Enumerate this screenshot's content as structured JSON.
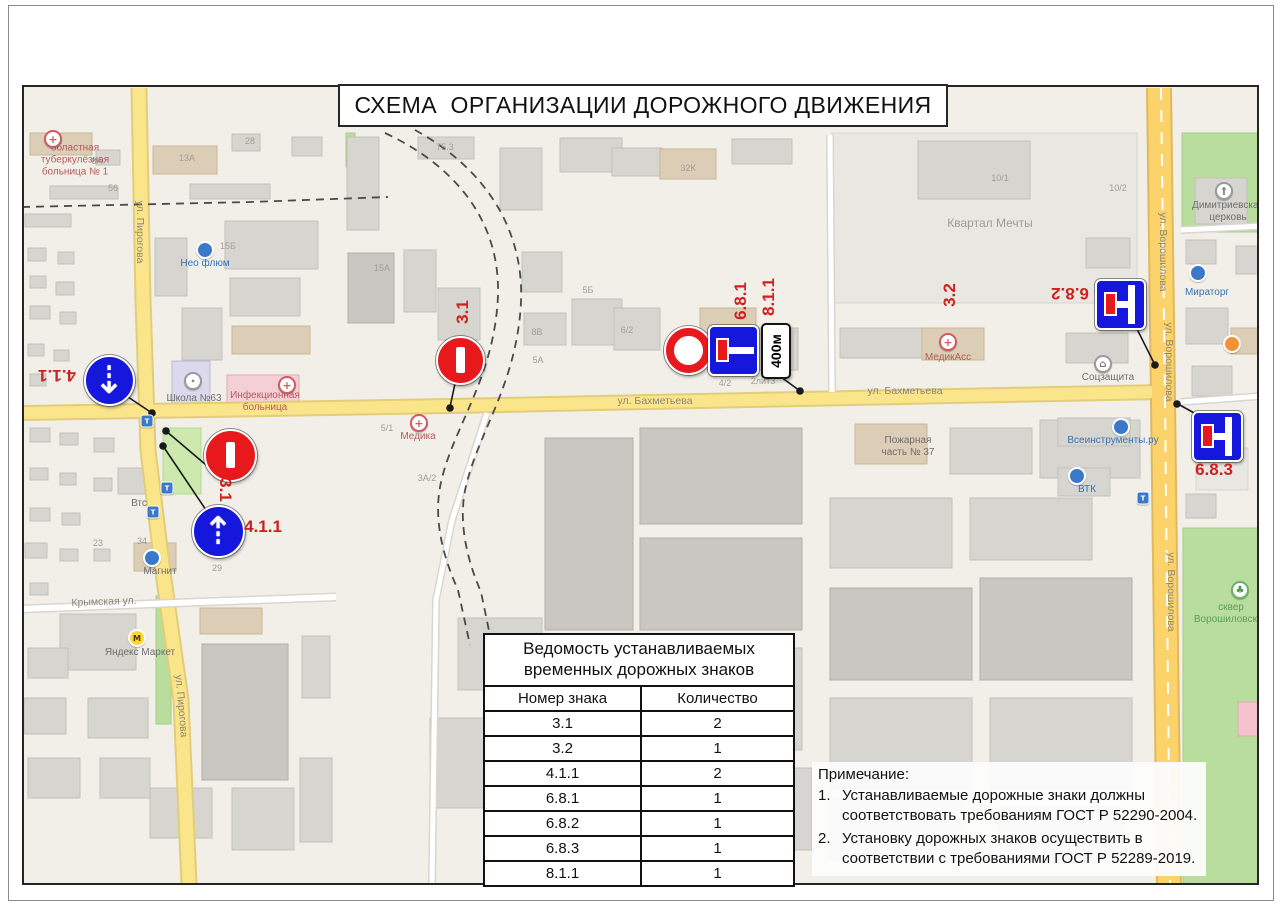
{
  "page": {
    "title": "СХЕМА  ОРГАНИЗАЦИИ ДОРОЖНОГО ДВИЖЕНИЯ"
  },
  "colors": {
    "sign_red": "#e8191c",
    "sign_blue": "#1518dc",
    "annotation_red": "#cf2020",
    "road_yellow": "#fbe58a",
    "major_road_yellow": "#fcd36a",
    "map_background": "#f2efe9",
    "park_green": "#b9dd9c"
  },
  "table": {
    "title_line1": "Ведомость устанавливаемых",
    "title_line2": "временных дорожных знаков",
    "columns": [
      "Номер знака",
      "Количество"
    ],
    "rows": [
      [
        "3.1",
        "2"
      ],
      [
        "3.2",
        "1"
      ],
      [
        "4.1.1",
        "2"
      ],
      [
        "6.8.1",
        "1"
      ],
      [
        "6.8.2",
        "1"
      ],
      [
        "6.8.3",
        "1"
      ],
      [
        "8.1.1",
        "1"
      ]
    ]
  },
  "notes": {
    "heading": "Примечание:",
    "items": [
      "Устанавливаемые дорожные знаки должны соответствовать требованиям ГОСТ Р 52290-2004.",
      "Установку дорожных знаков осуществить в соответствии с требованиями ГОСТ Р 52289-2019."
    ]
  },
  "signs": [
    {
      "number": "4.1.1",
      "type": "ahead",
      "glyph": "⇣",
      "x": 107,
      "y": 378,
      "d": 47
    },
    {
      "number": "3.1",
      "type": "no-entry",
      "x": 228,
      "y": 453,
      "d": 49
    },
    {
      "number": "4.1.1",
      "type": "ahead",
      "glyph": "⇡",
      "x": 216,
      "y": 529,
      "d": 49
    },
    {
      "number": "3.1",
      "type": "no-entry",
      "x": 458,
      "y": 358,
      "d": 45
    },
    {
      "number": "3.2",
      "type": "no-vehicles",
      "x": 686,
      "y": 348,
      "d": 45
    },
    {
      "number": "6.8.1",
      "type": "dead-end",
      "x": 731,
      "y": 348,
      "d": 47
    },
    {
      "number": "8.1.1",
      "type": "distance",
      "text": "400м",
      "x": 774,
      "y": 349,
      "w": 26,
      "h": 52
    },
    {
      "number": "6.8.2",
      "type": "dead-end-branch",
      "x": 1118,
      "y": 302,
      "d": 47
    },
    {
      "number": "6.8.3",
      "type": "dead-end-branch",
      "x": 1215,
      "y": 434,
      "d": 47
    }
  ],
  "sign_labels": [
    {
      "text": "4.1.1",
      "x": 57,
      "y": 375,
      "rot": 180
    },
    {
      "text": "3.1",
      "x": 225,
      "y": 490,
      "rot": 90
    },
    {
      "text": "4.1.1",
      "x": 263,
      "y": 527,
      "rot": 0
    },
    {
      "text": "3.1",
      "x": 463,
      "y": 312,
      "rot": -90
    },
    {
      "text": "3.2",
      "x": 950,
      "y": 295,
      "rot": -90
    },
    {
      "text": "6.8.1",
      "x": 741,
      "y": 301,
      "rot": -90
    },
    {
      "text": "8.1.1",
      "x": 769,
      "y": 297,
      "rot": -90
    },
    {
      "text": "6.8.2",
      "x": 1070,
      "y": 293,
      "rot": 180
    },
    {
      "text": "6.8.3",
      "x": 1214,
      "y": 470,
      "rot": 0
    }
  ],
  "map": {
    "labels": [
      {
        "text": "областная\nтуберкулёзная\nбольница № 1",
        "x": 75,
        "y": 160,
        "cls": "medical"
      },
      {
        "text": "Нео флюм",
        "x": 205,
        "y": 264,
        "cls": "poi-blue-label"
      },
      {
        "text": "Школа №63",
        "x": 194,
        "y": 399,
        "cls": "plain"
      },
      {
        "text": "Инфекционная\nбольница",
        "x": 265,
        "y": 402,
        "cls": "medical"
      },
      {
        "text": "Втс",
        "x": 139,
        "y": 504,
        "cls": "plain"
      },
      {
        "text": "Медика",
        "x": 418,
        "y": 437,
        "cls": "medical"
      },
      {
        "text": "ул. Бахметьева",
        "x": 655,
        "y": 401,
        "cls": "street"
      },
      {
        "text": "ул. Бахметьева",
        "x": 905,
        "y": 391,
        "cls": "street"
      },
      {
        "text": "Пожарная\nчасть № 37",
        "x": 908,
        "y": 447,
        "cls": "plain"
      },
      {
        "text": "МедикАсс",
        "x": 948,
        "y": 358,
        "cls": "medical"
      },
      {
        "text": "Соцзащита",
        "x": 1108,
        "y": 378,
        "cls": "plain"
      },
      {
        "text": "Всеинструменты.ру",
        "x": 1113,
        "y": 441,
        "cls": "poi-blue-label"
      },
      {
        "text": "ВТК",
        "x": 1087,
        "y": 490,
        "cls": "poi-blue-label"
      },
      {
        "text": "Мираторг",
        "x": 1207,
        "y": 293,
        "cls": "poi-blue-label"
      },
      {
        "text": "Димитриевская\nцерковь",
        "x": 1228,
        "y": 212,
        "cls": "plain"
      },
      {
        "text": "Квартал Мечты",
        "x": 990,
        "y": 223,
        "cls": "area"
      },
      {
        "text": "Яндекс Маркет",
        "x": 140,
        "y": 653,
        "cls": "plain"
      },
      {
        "text": "Магнит",
        "x": 160,
        "y": 572,
        "cls": "plain"
      },
      {
        "text": "Крымская ул.",
        "x": 104,
        "y": 602,
        "cls": "street",
        "rot": -2
      },
      {
        "text": "ул. Пирогова",
        "x": 140,
        "y": 232,
        "cls": "street",
        "rot": 90
      },
      {
        "text": "ул. Пирогова",
        "x": 181,
        "y": 706,
        "cls": "street",
        "rot": 85
      },
      {
        "text": "ул. Ворошилова",
        "x": 1163,
        "y": 252,
        "cls": "street",
        "rot": 90
      },
      {
        "text": "ул. Ворошилова",
        "x": 1169,
        "y": 362,
        "cls": "street",
        "rot": 90
      },
      {
        "text": "ул. Ворошилова",
        "x": 1171,
        "y": 592,
        "cls": "street",
        "rot": 90
      },
      {
        "text": "сквер\nВорошиловский",
        "x": 1231,
        "y": 614,
        "cls": "park-label"
      }
    ],
    "building_numbers": [
      [
        "13А",
        187,
        158
      ],
      [
        "8А",
        97,
        161
      ],
      [
        "56",
        113,
        188
      ],
      [
        "28",
        250,
        141
      ],
      [
        "75.3",
        445,
        147
      ],
      [
        "15Б",
        228,
        246
      ],
      [
        "15А",
        382,
        268
      ],
      [
        "5Б",
        588,
        290
      ],
      [
        "5А",
        538,
        360
      ],
      [
        "32К",
        688,
        168
      ],
      [
        "10/1",
        1000,
        178
      ],
      [
        "10/2",
        1118,
        188
      ],
      [
        "8В",
        537,
        332
      ],
      [
        "6/2",
        627,
        330
      ],
      [
        "4/2",
        725,
        383
      ],
      [
        "2лит3",
        763,
        381
      ],
      [
        "5/1",
        387,
        428
      ],
      [
        "3А/2",
        427,
        478
      ],
      [
        "29",
        217,
        568
      ],
      [
        "34",
        142,
        541
      ],
      [
        "23",
        98,
        543
      ]
    ],
    "pois": [
      {
        "type": "medical",
        "x": 53,
        "y": 139
      },
      {
        "type": "medical",
        "x": 287,
        "y": 385
      },
      {
        "type": "medical",
        "x": 419,
        "y": 423
      },
      {
        "type": "medical",
        "x": 948,
        "y": 342
      },
      {
        "type": "blue",
        "x": 205,
        "y": 250
      },
      {
        "type": "blue",
        "x": 1121,
        "y": 427
      },
      {
        "type": "blue",
        "x": 1077,
        "y": 476
      },
      {
        "type": "blue",
        "x": 1198,
        "y": 273
      },
      {
        "type": "blue",
        "x": 152,
        "y": 558
      },
      {
        "type": "school",
        "x": 193,
        "y": 381
      },
      {
        "type": "social",
        "x": 1103,
        "y": 364
      },
      {
        "type": "church",
        "x": 1224,
        "y": 191
      },
      {
        "type": "yellow",
        "x": 137,
        "y": 638
      },
      {
        "type": "tree",
        "x": 1240,
        "y": 590
      },
      {
        "type": "orange",
        "x": 1232,
        "y": 344
      },
      {
        "type": "transport",
        "x": 147,
        "y": 421
      },
      {
        "type": "transport",
        "x": 167,
        "y": 488
      },
      {
        "type": "transport",
        "x": 153,
        "y": 512
      },
      {
        "type": "transport",
        "x": 1143,
        "y": 498
      }
    ],
    "buildings": [
      [
        "t",
        30,
        133,
        62,
        22
      ],
      [
        "g",
        96,
        150,
        24,
        15
      ],
      [
        "g",
        50,
        186,
        68,
        13
      ],
      [
        "g",
        25,
        214,
        46,
        13
      ],
      [
        "g",
        28,
        248,
        18,
        13
      ],
      [
        "g",
        58,
        252,
        16,
        12
      ],
      [
        "g",
        30,
        276,
        16,
        12
      ],
      [
        "g",
        56,
        282,
        18,
        13
      ],
      [
        "g",
        30,
        306,
        20,
        13
      ],
      [
        "g",
        60,
        312,
        16,
        12
      ],
      [
        "g",
        28,
        344,
        16,
        12
      ],
      [
        "g",
        54,
        350,
        15,
        11
      ],
      [
        "g",
        30,
        374,
        16,
        12
      ],
      [
        "t",
        153,
        146,
        64,
        28
      ],
      [
        "g",
        232,
        134,
        28,
        17
      ],
      [
        "g",
        292,
        137,
        30,
        19
      ],
      [
        "g",
        190,
        184,
        80,
        15
      ],
      [
        "g",
        155,
        238,
        32,
        58
      ],
      [
        "g",
        225,
        221,
        93,
        48
      ],
      [
        "g",
        230,
        278,
        70,
        38
      ],
      [
        "g",
        182,
        308,
        40,
        52
      ],
      [
        "t",
        232,
        326,
        78,
        28
      ],
      [
        "s",
        172,
        361,
        38,
        46
      ],
      [
        "p",
        227,
        375,
        72,
        38
      ],
      [
        "g",
        347,
        137,
        32,
        93
      ],
      [
        "g",
        418,
        137,
        56,
        22
      ],
      [
        "d",
        348,
        253,
        46,
        70
      ],
      [
        "g",
        404,
        250,
        32,
        62
      ],
      [
        "g",
        438,
        288,
        42,
        52
      ],
      [
        "g",
        500,
        148,
        42,
        62
      ],
      [
        "g",
        560,
        138,
        62,
        34
      ],
      [
        "g",
        522,
        252,
        40,
        40
      ],
      [
        "g",
        612,
        148,
        50,
        28
      ],
      [
        "t",
        660,
        149,
        56,
        30
      ],
      [
        "g",
        732,
        139,
        60,
        25
      ],
      [
        "g",
        524,
        313,
        42,
        32
      ],
      [
        "g",
        572,
        299,
        50,
        46
      ],
      [
        "g",
        614,
        308,
        46,
        42
      ],
      [
        "t",
        700,
        308,
        56,
        46
      ],
      [
        "g",
        758,
        328,
        40,
        42
      ],
      [
        "l",
        832,
        133,
        305,
        170
      ],
      [
        "g",
        918,
        141,
        112,
        58
      ],
      [
        "g",
        840,
        328,
        82,
        30
      ],
      [
        "t",
        922,
        328,
        62,
        32
      ],
      [
        "g",
        1066,
        333,
        62,
        30
      ],
      [
        "g",
        1086,
        238,
        44,
        30
      ],
      [
        "g",
        1195,
        178,
        52,
        46
      ],
      [
        "g",
        1186,
        240,
        30,
        24
      ],
      [
        "g",
        1236,
        246,
        24,
        28
      ],
      [
        "g",
        1186,
        308,
        42,
        36
      ],
      [
        "t",
        1231,
        328,
        28,
        26
      ],
      [
        "g",
        1192,
        366,
        40,
        30
      ],
      [
        "l",
        1196,
        448,
        52,
        42
      ],
      [
        "g",
        1186,
        494,
        30,
        24
      ],
      [
        "pk",
        1238,
        702,
        24,
        34
      ],
      [
        "g",
        30,
        428,
        20,
        14
      ],
      [
        "g",
        60,
        433,
        18,
        12
      ],
      [
        "g",
        94,
        438,
        20,
        14
      ],
      [
        "g",
        30,
        468,
        18,
        12
      ],
      [
        "g",
        60,
        473,
        16,
        12
      ],
      [
        "g",
        94,
        478,
        18,
        13
      ],
      [
        "g",
        30,
        508,
        20,
        13
      ],
      [
        "g",
        62,
        513,
        18,
        12
      ],
      [
        "g",
        25,
        543,
        22,
        15
      ],
      [
        "g",
        60,
        549,
        18,
        12
      ],
      [
        "g",
        94,
        549,
        16,
        12
      ],
      [
        "g",
        30,
        583,
        18,
        12
      ],
      [
        "g",
        118,
        468,
        36,
        26
      ],
      [
        "t",
        134,
        543,
        42,
        28
      ],
      [
        "g",
        60,
        614,
        76,
        56
      ],
      [
        "t",
        200,
        608,
        62,
        26
      ],
      [
        "d",
        202,
        644,
        86,
        136
      ],
      [
        "g",
        88,
        698,
        60,
        40
      ],
      [
        "g",
        28,
        648,
        40,
        30
      ],
      [
        "g",
        24,
        698,
        42,
        36
      ],
      [
        "g",
        28,
        758,
        52,
        40
      ],
      [
        "g",
        100,
        758,
        50,
        40
      ],
      [
        "g",
        150,
        788,
        62,
        50
      ],
      [
        "g",
        232,
        788,
        62,
        62
      ],
      [
        "g",
        300,
        758,
        32,
        84
      ],
      [
        "g",
        302,
        636,
        28,
        62
      ],
      [
        "d",
        545,
        438,
        88,
        192
      ],
      [
        "d",
        640,
        428,
        162,
        96
      ],
      [
        "d",
        640,
        538,
        162,
        92
      ],
      [
        "g",
        458,
        618,
        84,
        72
      ],
      [
        "g",
        430,
        718,
        102,
        90
      ],
      [
        "g",
        545,
        648,
        102,
        82
      ],
      [
        "g",
        658,
        648,
        144,
        102
      ],
      [
        "g",
        560,
        748,
        122,
        92
      ],
      [
        "g",
        700,
        768,
        112,
        82
      ],
      [
        "t",
        855,
        424,
        72,
        40
      ],
      [
        "g",
        950,
        428,
        82,
        46
      ],
      [
        "g",
        1040,
        420,
        100,
        58
      ],
      [
        "g",
        830,
        498,
        122,
        70
      ],
      [
        "g",
        970,
        498,
        122,
        62
      ],
      [
        "d",
        830,
        588,
        142,
        92
      ],
      [
        "d",
        980,
        578,
        152,
        102
      ],
      [
        "g",
        830,
        698,
        142,
        92
      ],
      [
        "g",
        990,
        698,
        142,
        92
      ],
      [
        "g",
        830,
        798,
        132,
        62
      ],
      [
        "g",
        1000,
        808,
        122,
        55
      ],
      [
        "g",
        1058,
        418,
        72,
        28
      ],
      [
        "g",
        1058,
        468,
        52,
        28
      ]
    ],
    "greens": [
      [
        1182,
        133,
        78,
        99
      ],
      [
        1183,
        528,
        79,
        356
      ],
      [
        156,
        596,
        15,
        128
      ],
      [
        346,
        133,
        9,
        34
      ]
    ],
    "light_greens": [
      [
        163,
        428,
        38,
        66
      ]
    ]
  }
}
